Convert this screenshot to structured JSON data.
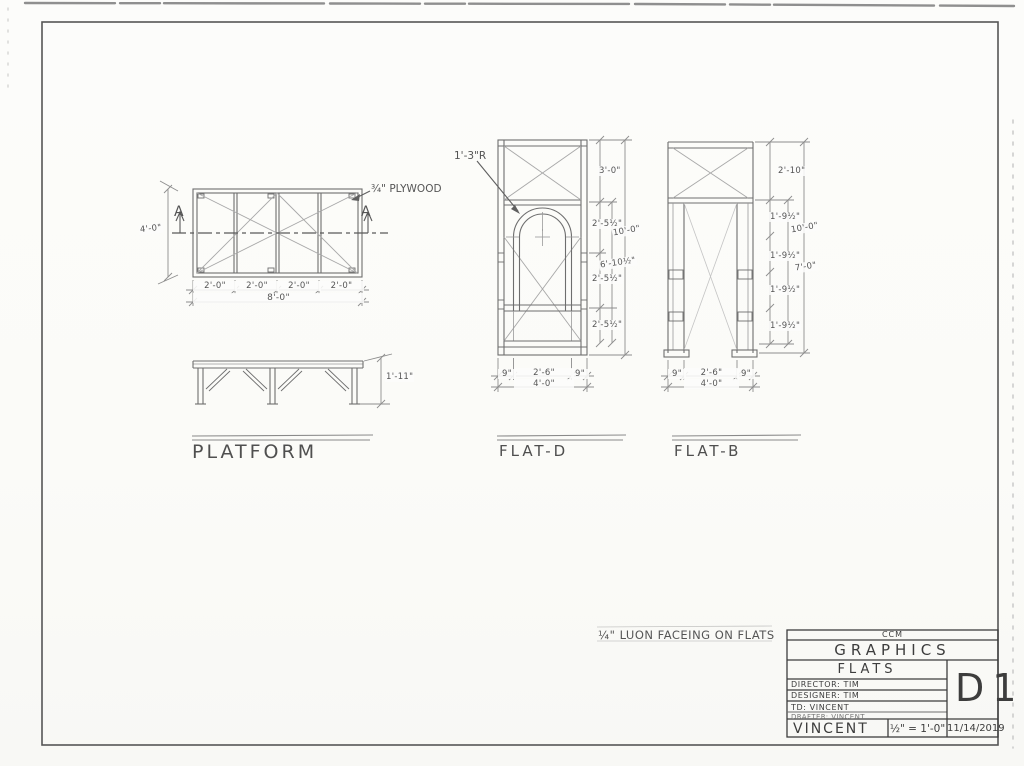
{
  "colors": {
    "pencil": "#6e6e6e",
    "pencil_light": "#a5a5a5",
    "ink_dark": "#3d3d3d",
    "paper": "#fbfbf8"
  },
  "platform": {
    "label": "PLATFORM",
    "plywood_note": "¾\" PLYWOOD",
    "section_letter_left": "A",
    "section_letter_right": "A",
    "depth": "4'-0\"",
    "bays": [
      "2'-0\"",
      "2'-0\"",
      "2'-0\"",
      "2'-0\""
    ],
    "width_total": "8'-0\"",
    "height": "1'-11\""
  },
  "flat_d": {
    "label": "FLAT-D",
    "arch_radius": "1'-3\"R",
    "seg_dims": [
      "3'-0\"",
      "2'-5½\"",
      "2'-5½\"",
      "2'-5½\""
    ],
    "opening_height": "6'-10½\"",
    "overall_height": "10'-0\"",
    "bottom_segs": [
      "9\"",
      "2'-6\"",
      "9\""
    ],
    "width_total": "4'-0\""
  },
  "flat_b": {
    "label": "FLAT-B",
    "top_seg": "2'-10\"",
    "seg_dims": [
      "1'-9½\"",
      "1'-9½\"",
      "1'-9½\"",
      "1'-9½\""
    ],
    "opening_height": "7'-0\"",
    "overall_height": "10'-0\"",
    "bottom_segs": [
      "9\"",
      "2'-6\"",
      "9\""
    ],
    "width_total": "4'-0\""
  },
  "note": {
    "text": "¼\" LUON FACEING ON FLATS"
  },
  "title_block": {
    "org": "CCM",
    "dept": "GRAPHICS",
    "project": "FLATS",
    "director": "DIRECTOR: TIM",
    "designer": "DESIGNER: TIM",
    "td": "TD: VINCENT",
    "drafter": "DRAFTER: VINCENT",
    "name": "VINCENT",
    "scale": "½\" = 1'-0\"",
    "date": "11/14/2019",
    "sheet": "D1"
  }
}
